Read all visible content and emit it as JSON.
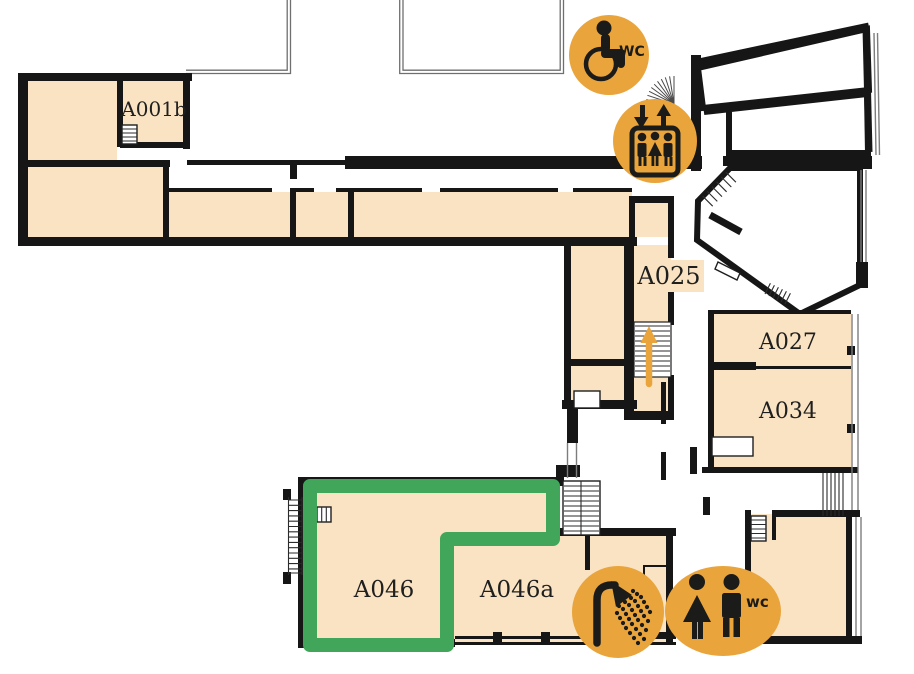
{
  "page": {
    "kind": "indoor floor plan viewer",
    "background": "#ffffff"
  },
  "colors": {
    "room_fill": "#FAE3C2",
    "wall": "#161616",
    "highlight_green": "#42A65A",
    "icon_orange": "#E9A43C",
    "icon_glyph": "#1B1B19",
    "label_text": "#1F1F1F"
  },
  "rooms": {
    "a001b": {
      "label": "A001b"
    },
    "a025": {
      "label": "A025"
    },
    "a027": {
      "label": "A027"
    },
    "a034": {
      "label": "A034"
    },
    "a046": {
      "label": "A046",
      "highlighted": true
    },
    "a046a": {
      "label": "A046a"
    }
  },
  "icons": {
    "accessible_wc": {
      "kind": "accessible-toilet",
      "badge": "WC"
    },
    "elevator": {
      "kind": "elevator"
    },
    "shower": {
      "kind": "shower"
    },
    "toilets": {
      "kind": "toilets-men-women",
      "badge": "wc"
    }
  },
  "highlight": {
    "room": "A046"
  },
  "stairs": {
    "arrow_direction": "up"
  }
}
